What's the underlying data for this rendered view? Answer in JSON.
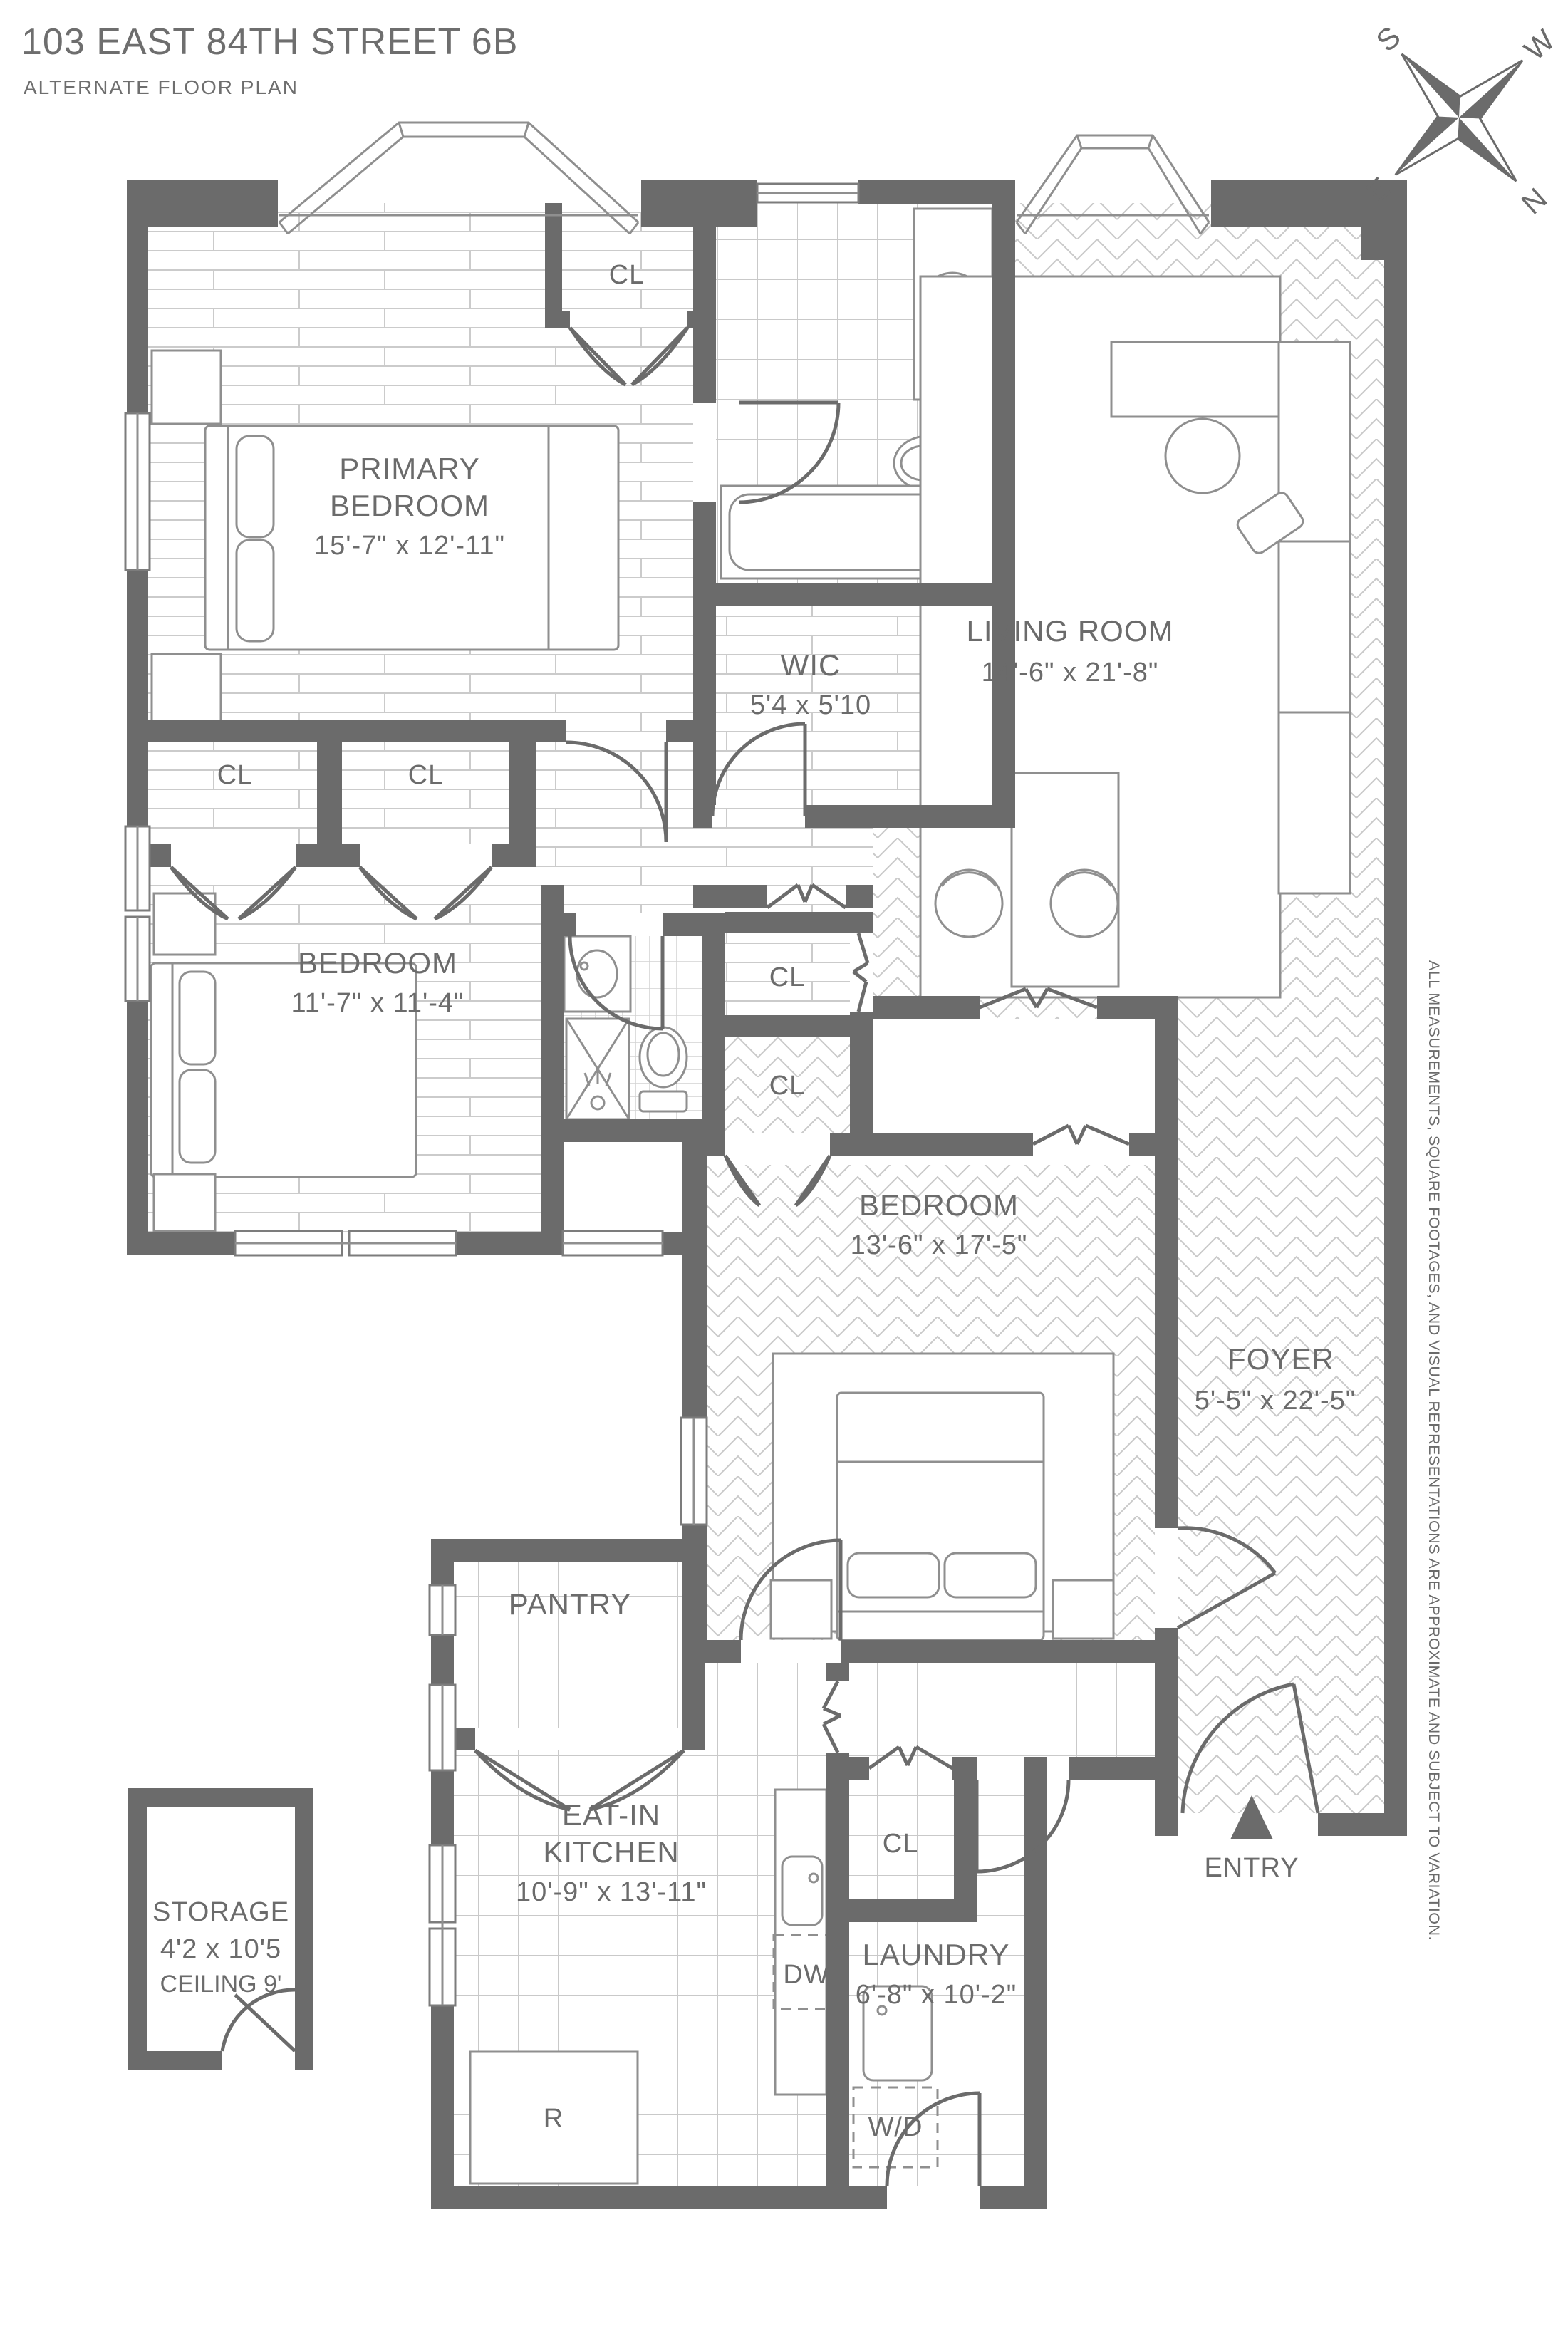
{
  "header": {
    "title": "103 EAST 84TH STREET 6B",
    "subtitle": "ALTERNATE FLOOR PLAN"
  },
  "compass": {
    "s": "S",
    "w": "W",
    "e": "E",
    "n": "N"
  },
  "disclaimer": "ALL MEASUREMENTS, SQUARE FOOTAGES, AND VISUAL REPRESENTATIONS ARE APPROXIMATE AND SUBJECT TO VARIATION.",
  "rooms": {
    "primary_bedroom": {
      "name_line1": "PRIMARY",
      "name_line2": "BEDROOM",
      "dims": "15'-7\" x 12'-11\""
    },
    "living_room": {
      "name": "LIVING ROOM",
      "dims": "14'-6\" x 21'-8\""
    },
    "wic": {
      "name": "WIC",
      "dims": "5'4 x 5'10"
    },
    "bedroom_2": {
      "name": "BEDROOM",
      "dims": "11'-7\" x 11'-4\""
    },
    "bedroom_3": {
      "name": "BEDROOM",
      "dims": "13'-6\" x 17'-5\""
    },
    "foyer": {
      "name": "FOYER",
      "dims": "5'-5\" x 22'-5\""
    },
    "pantry": {
      "name": "PANTRY"
    },
    "kitchen": {
      "name_line1": "EAT-IN",
      "name_line2": "KITCHEN",
      "dims": "10'-9\" x 13'-11\""
    },
    "laundry": {
      "name": "LAUNDRY",
      "dims": "6'-8\" x 10'-2\""
    },
    "storage": {
      "name": "STORAGE",
      "dims": "4'2 x 10'5",
      "ceiling": "CEILING 9'"
    }
  },
  "closets": {
    "label": "CL"
  },
  "appliances": {
    "dishwasher": "DW",
    "washer_dryer": "W/D",
    "range": "R"
  },
  "entry": {
    "label": "ENTRY"
  }
}
